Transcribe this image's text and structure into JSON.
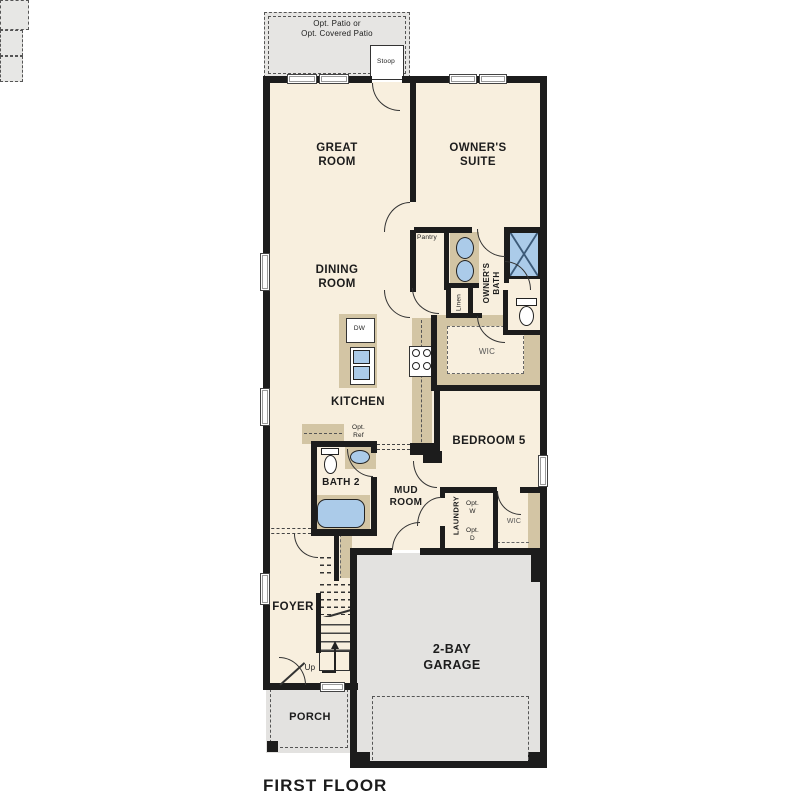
{
  "title": "FIRST FLOOR",
  "colors": {
    "wall": "#1c1c1c",
    "floor": "#f8efde",
    "outdoor_gray": "#e3e2e0",
    "cabinet_tan": "#d3c5a4",
    "fixture_blue": "#abcbe9",
    "background": "#ffffff"
  },
  "labels": {
    "patio": "Opt. Patio or\nOpt. Covered Patio",
    "stoop": "Stoop",
    "great_room": "GREAT\nROOM",
    "owners_suite": "OWNER'S\nSUITE",
    "dining_room": "DINING\nROOM",
    "pantry": "Pantry",
    "owners_bath": "OWNER'S\nBATH",
    "linen": "Linen",
    "wic_owners": "WIC",
    "kitchen": "KITCHEN",
    "dishwasher": "DW",
    "opt_ref": "Opt.\nRef",
    "bath2": "BATH 2",
    "mud_room": "MUD\nROOM",
    "bedroom5": "BEDROOM 5",
    "laundry": "LAUNDRY",
    "opt_washer": "Opt.\nW",
    "opt_dryer": "Opt.\nD",
    "wic_bedroom5": "WIC",
    "foyer": "FOYER",
    "up": "Up",
    "garage": "2-BAY\nGARAGE",
    "porch": "PORCH",
    "title": "FIRST FLOOR"
  }
}
